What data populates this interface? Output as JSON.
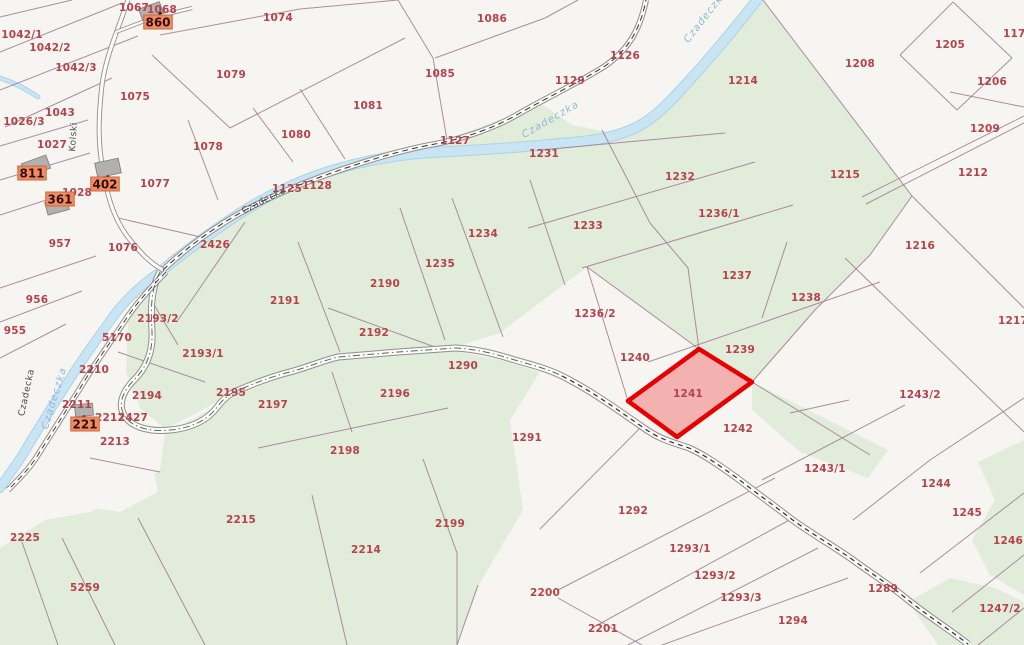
{
  "map": {
    "title": "cadastral-parcel-map",
    "highlighted_parcel": {
      "number": "1241"
    },
    "colors": {
      "background": "#f7f5f1",
      "vegetation": "#e2ecda",
      "river": "#c9e4f3",
      "parcel_line": "#9f7b91",
      "parcel_number": "#b5424c",
      "highlight_stroke": "#e60000",
      "highlight_fill": "rgba(237,97,97,0.45)",
      "address_label_bg": "#f28b62",
      "building_fill": "#b3b1ae"
    },
    "parcel_labels": [
      {
        "n": "1067",
        "x": 134,
        "y": 7
      },
      {
        "n": "1068",
        "x": 162,
        "y": 9
      },
      {
        "n": "1042/1",
        "x": 22,
        "y": 34
      },
      {
        "n": "1042/2",
        "x": 50,
        "y": 47
      },
      {
        "n": "1042/3",
        "x": 76,
        "y": 67
      },
      {
        "n": "1074",
        "x": 278,
        "y": 17
      },
      {
        "n": "1079",
        "x": 231,
        "y": 74
      },
      {
        "n": "1075",
        "x": 135,
        "y": 96
      },
      {
        "n": "1043",
        "x": 60,
        "y": 112
      },
      {
        "n": "1026/3",
        "x": 24,
        "y": 121
      },
      {
        "n": "1027",
        "x": 52,
        "y": 144
      },
      {
        "n": "1028",
        "x": 77,
        "y": 192
      },
      {
        "n": "1077",
        "x": 155,
        "y": 183
      },
      {
        "n": "1078",
        "x": 208,
        "y": 146
      },
      {
        "n": "957",
        "x": 60,
        "y": 243
      },
      {
        "n": "1076",
        "x": 123,
        "y": 247
      },
      {
        "n": "956",
        "x": 37,
        "y": 299
      },
      {
        "n": "955",
        "x": 15,
        "y": 330
      },
      {
        "n": "1086",
        "x": 492,
        "y": 18
      },
      {
        "n": "1085",
        "x": 440,
        "y": 73
      },
      {
        "n": "1081",
        "x": 368,
        "y": 105
      },
      {
        "n": "1080",
        "x": 296,
        "y": 134
      },
      {
        "n": "1127",
        "x": 455,
        "y": 140
      },
      {
        "n": "1125",
        "x": 287,
        "y": 188
      },
      {
        "n": "1128",
        "x": 317,
        "y": 185
      },
      {
        "n": "1126",
        "x": 625,
        "y": 55
      },
      {
        "n": "1129",
        "x": 570,
        "y": 80
      },
      {
        "n": "2426",
        "x": 215,
        "y": 244
      },
      {
        "n": "1214",
        "x": 743,
        "y": 80
      },
      {
        "n": "1205",
        "x": 950,
        "y": 44
      },
      {
        "n": "1208",
        "x": 860,
        "y": 63
      },
      {
        "n": "1206",
        "x": 992,
        "y": 81
      },
      {
        "n": "1209",
        "x": 985,
        "y": 128
      },
      {
        "n": "1175",
        "x": 1018,
        "y": 33
      },
      {
        "n": "1215",
        "x": 845,
        "y": 174
      },
      {
        "n": "1212",
        "x": 973,
        "y": 172
      },
      {
        "n": "1216",
        "x": 920,
        "y": 245
      },
      {
        "n": "1217",
        "x": 1013,
        "y": 320
      },
      {
        "n": "1231",
        "x": 544,
        "y": 153
      },
      {
        "n": "1232",
        "x": 680,
        "y": 176
      },
      {
        "n": "1233",
        "x": 588,
        "y": 225
      },
      {
        "n": "1234",
        "x": 483,
        "y": 233
      },
      {
        "n": "1235",
        "x": 440,
        "y": 263
      },
      {
        "n": "1236/1",
        "x": 719,
        "y": 213
      },
      {
        "n": "1236/2",
        "x": 595,
        "y": 313
      },
      {
        "n": "1237",
        "x": 737,
        "y": 275
      },
      {
        "n": "1238",
        "x": 806,
        "y": 297
      },
      {
        "n": "1239",
        "x": 740,
        "y": 349
      },
      {
        "n": "1240",
        "x": 635,
        "y": 357
      },
      {
        "n": "1241",
        "x": 688,
        "y": 393
      },
      {
        "n": "1242",
        "x": 738,
        "y": 428
      },
      {
        "n": "2190",
        "x": 385,
        "y": 283
      },
      {
        "n": "2191",
        "x": 285,
        "y": 300
      },
      {
        "n": "2192",
        "x": 374,
        "y": 332
      },
      {
        "n": "2193/1",
        "x": 203,
        "y": 353
      },
      {
        "n": "2193/2",
        "x": 158,
        "y": 318
      },
      {
        "n": "2194",
        "x": 147,
        "y": 395
      },
      {
        "n": "2195",
        "x": 231,
        "y": 392
      },
      {
        "n": "2196",
        "x": 395,
        "y": 393
      },
      {
        "n": "2197",
        "x": 273,
        "y": 404
      },
      {
        "n": "2198",
        "x": 345,
        "y": 450
      },
      {
        "n": "2199",
        "x": 450,
        "y": 523
      },
      {
        "n": "2210",
        "x": 94,
        "y": 369
      },
      {
        "n": "5170",
        "x": 117,
        "y": 337
      },
      {
        "n": "2211",
        "x": 77,
        "y": 404
      },
      {
        "n": "2212",
        "x": 110,
        "y": 417
      },
      {
        "n": "2427",
        "x": 133,
        "y": 417
      },
      {
        "n": "2213",
        "x": 115,
        "y": 441
      },
      {
        "n": "2214",
        "x": 366,
        "y": 549
      },
      {
        "n": "2215",
        "x": 241,
        "y": 519
      },
      {
        "n": "2225",
        "x": 25,
        "y": 537
      },
      {
        "n": "5259",
        "x": 85,
        "y": 587
      },
      {
        "n": "1290",
        "x": 463,
        "y": 365
      },
      {
        "n": "1291",
        "x": 527,
        "y": 437
      },
      {
        "n": "1292",
        "x": 633,
        "y": 510
      },
      {
        "n": "1293/1",
        "x": 690,
        "y": 548
      },
      {
        "n": "1293/2",
        "x": 715,
        "y": 575
      },
      {
        "n": "1293/3",
        "x": 741,
        "y": 597
      },
      {
        "n": "1294",
        "x": 793,
        "y": 620
      },
      {
        "n": "2200",
        "x": 545,
        "y": 592
      },
      {
        "n": "2201",
        "x": 603,
        "y": 628
      },
      {
        "n": "1243/1",
        "x": 825,
        "y": 468
      },
      {
        "n": "1243/2",
        "x": 920,
        "y": 394
      },
      {
        "n": "1244",
        "x": 936,
        "y": 483
      },
      {
        "n": "1245",
        "x": 967,
        "y": 512
      },
      {
        "n": "1246",
        "x": 1008,
        "y": 540
      },
      {
        "n": "1247/2",
        "x": 1000,
        "y": 608
      },
      {
        "n": "1289",
        "x": 883,
        "y": 588
      }
    ],
    "address_labels": [
      {
        "n": "860",
        "x": 158,
        "y": 22
      },
      {
        "n": "811",
        "x": 32,
        "y": 173
      },
      {
        "n": "402",
        "x": 105,
        "y": 184
      },
      {
        "n": "361",
        "x": 60,
        "y": 199
      },
      {
        "n": "221",
        "x": 85,
        "y": 424
      }
    ],
    "street_labels": [
      {
        "t": "Czadecka",
        "x": 265,
        "y": 203,
        "r": -27
      },
      {
        "t": "Czadecka",
        "x": 29,
        "y": 393,
        "r": -78
      },
      {
        "t": "Kolski",
        "x": 76,
        "y": 137,
        "r": -86
      }
    ],
    "river_labels": [
      {
        "t": "Czadeczka",
        "x": 57,
        "y": 399,
        "r": -73
      },
      {
        "t": "Czadeczka",
        "x": 552,
        "y": 122,
        "r": -30
      },
      {
        "t": "Czadeczka",
        "x": 708,
        "y": 18,
        "r": -52
      }
    ]
  }
}
